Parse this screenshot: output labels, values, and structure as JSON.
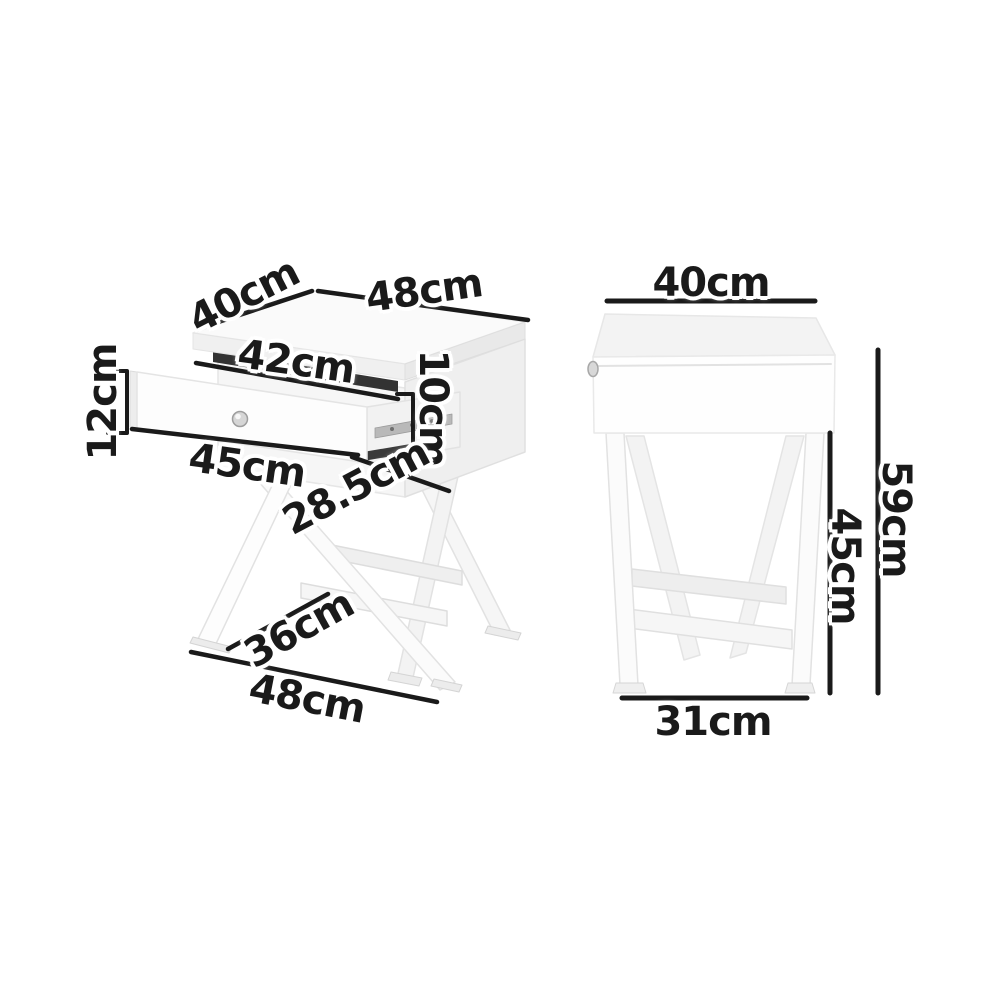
{
  "dimensions": {
    "left_view": {
      "top_depth": "40cm",
      "top_width": "48cm",
      "drawer_inner_width": "42cm",
      "drawer_front_height": "12cm",
      "drawer_side_height": "10cm",
      "drawer_front_width": "45cm",
      "drawer_depth": "28.5cm",
      "leg_depth": "36cm",
      "base_depth": "48cm"
    },
    "right_view": {
      "top_width": "40cm",
      "leg_height": "45cm",
      "total_height": "59cm",
      "feet_width": "31cm"
    }
  },
  "colors": {
    "background": "#ffffff",
    "dimension_line": "#1a1a1a",
    "label_text": "#1a1a1a",
    "label_halo": "#ffffff",
    "furniture_white": "#fcfcfc",
    "furniture_light_shade": "#f1f1f1",
    "furniture_mid_shade": "#e9e9e9",
    "furniture_edge": "#e2e2e2",
    "drawer_gap_dark": "#333333",
    "drawer_rail_gray": "#b9b9b9",
    "knob_gray": "#d6d6d6"
  }
}
